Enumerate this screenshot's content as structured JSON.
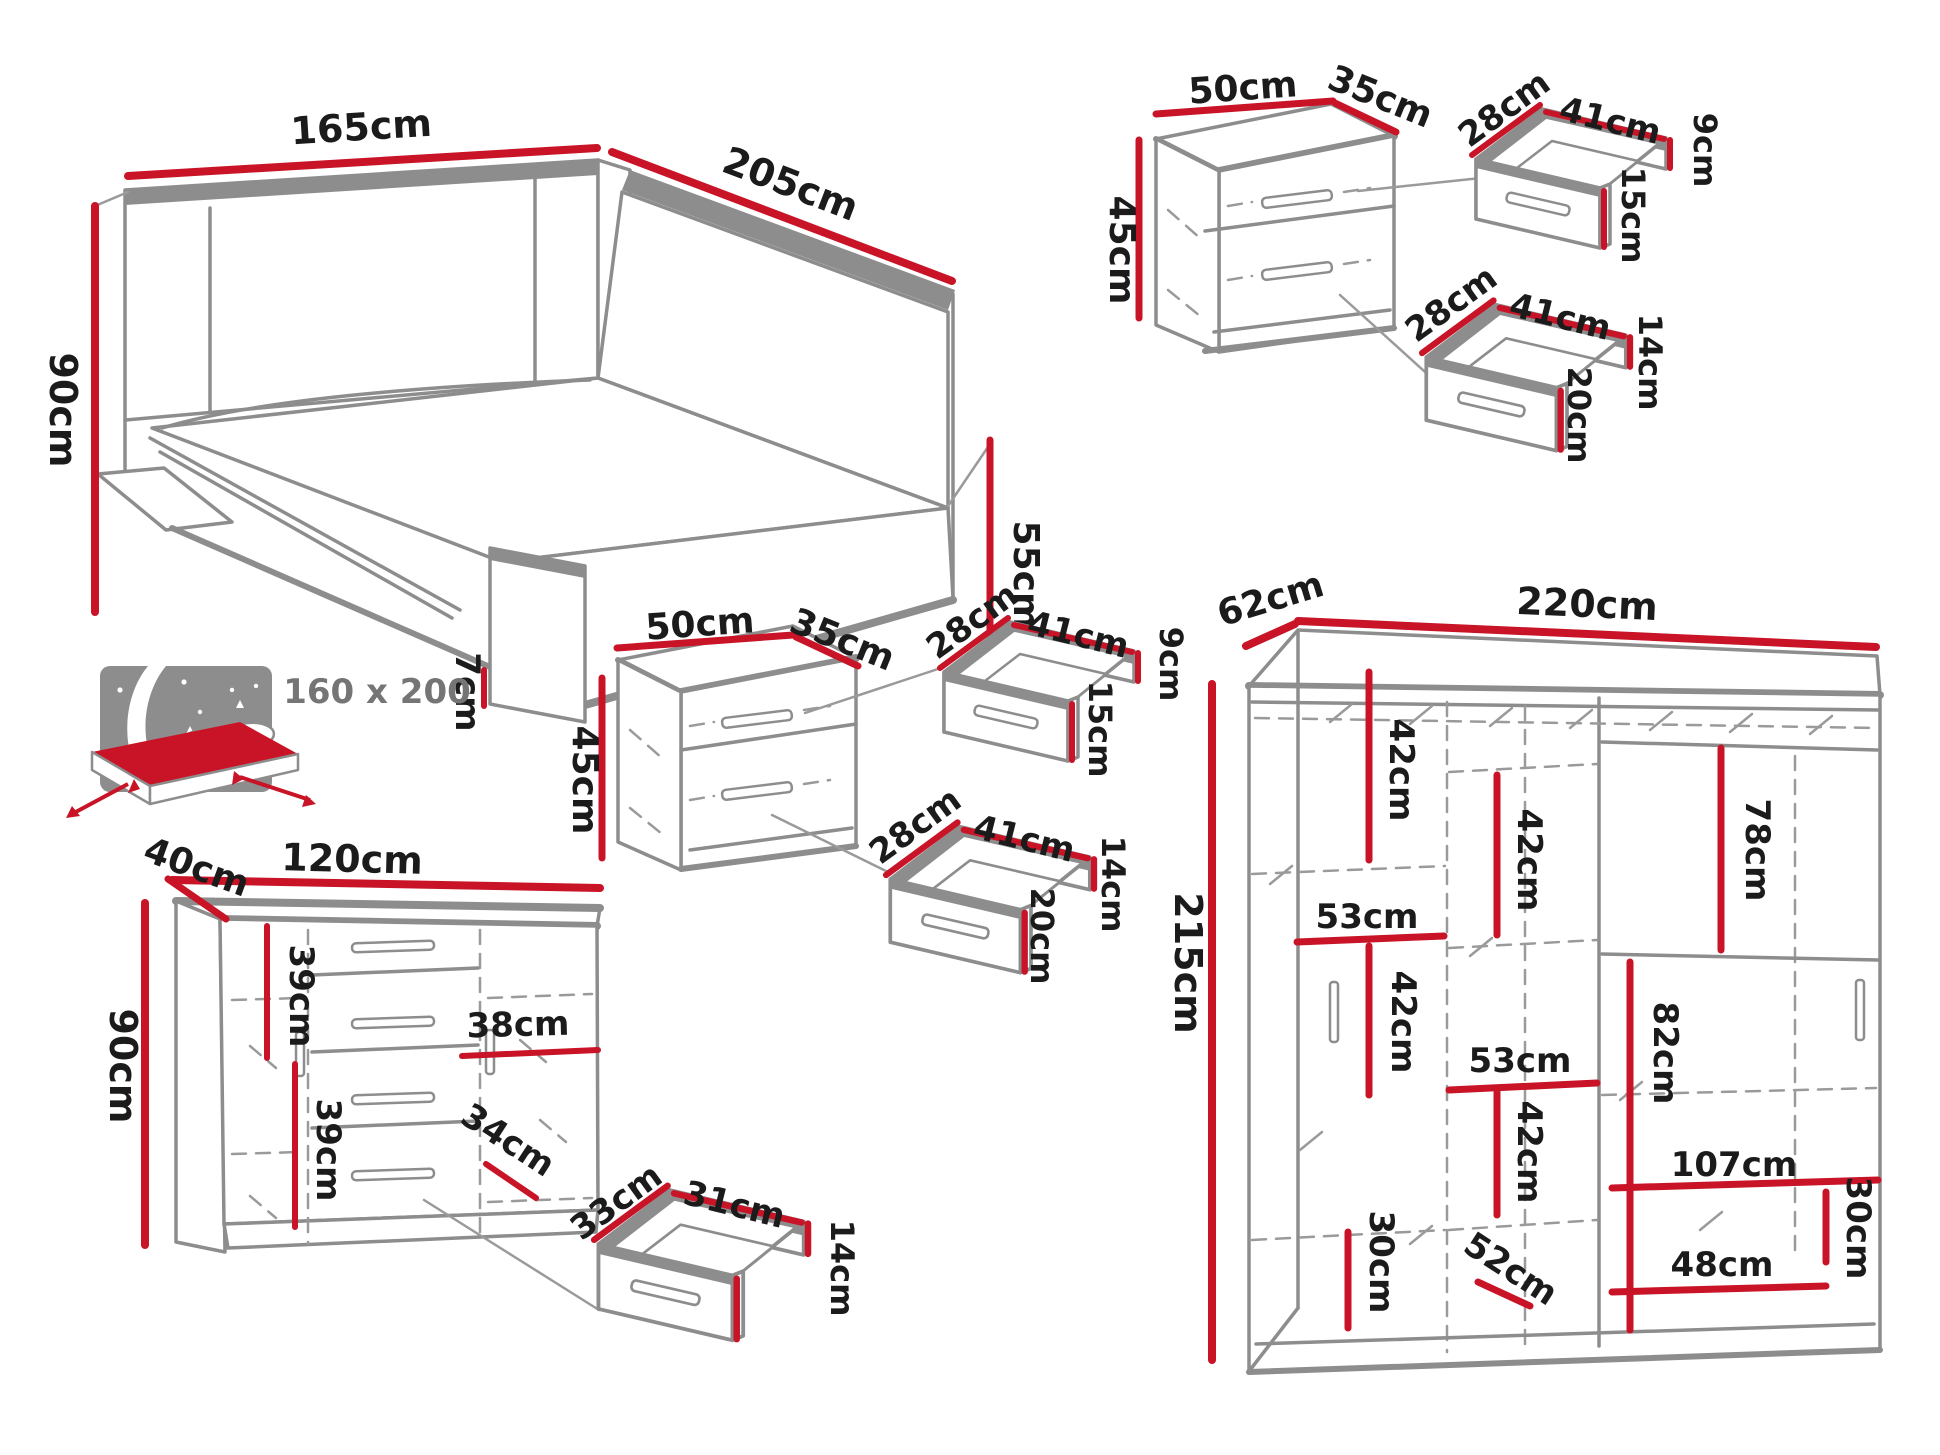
{
  "colors": {
    "dimension": "#c81426",
    "outline": "#8d8d8d",
    "text": "#1b1b1b",
    "muted": "#757575"
  },
  "bed": {
    "width": "165cm",
    "length": "205cm",
    "height": "90cm",
    "side_height": "55cm",
    "leg_height": "7cm",
    "mattress_size": "160 x 200"
  },
  "nightstand_top_right": {
    "width": "50cm",
    "depth": "35cm",
    "height": "45cm",
    "drawer_small": {
      "depth": "28cm",
      "width": "41cm",
      "back_height": "9cm",
      "front_height": "15cm"
    },
    "drawer_large": {
      "depth": "28cm",
      "width": "41cm",
      "back_height": "14cm",
      "front_height": "20cm"
    }
  },
  "nightstand_middle": {
    "width": "50cm",
    "depth": "35cm",
    "height": "45cm",
    "drawer_small": {
      "depth": "28cm",
      "width": "41cm",
      "back_height": "9cm",
      "front_height": "15cm"
    },
    "drawer_large": {
      "depth": "28cm",
      "width": "41cm",
      "back_height": "14cm",
      "front_height": "20cm"
    }
  },
  "dresser": {
    "depth": "40cm",
    "width": "120cm",
    "height": "90cm",
    "upper_section": "39cm",
    "lower_section": "39cm",
    "drawer_section_width": "38cm",
    "bottom_section": "34cm",
    "drawer": {
      "depth": "33cm",
      "width": "31cm",
      "height": "14cm"
    }
  },
  "wardrobe": {
    "depth": "62cm",
    "width": "220cm",
    "height": "215cm",
    "interior": {
      "left_top": "42cm",
      "left_width": "53cm",
      "left_middle": "42cm",
      "left_bottom": "30cm",
      "center_top": "42cm",
      "center_width": "53cm",
      "center_bottom": "42cm",
      "bottom_diagonal": "52cm",
      "right_top": "78cm",
      "right_middle": "82cm",
      "shelf_width": "107cm",
      "right_bottom": "30cm",
      "bottom_shelf": "48cm"
    }
  }
}
